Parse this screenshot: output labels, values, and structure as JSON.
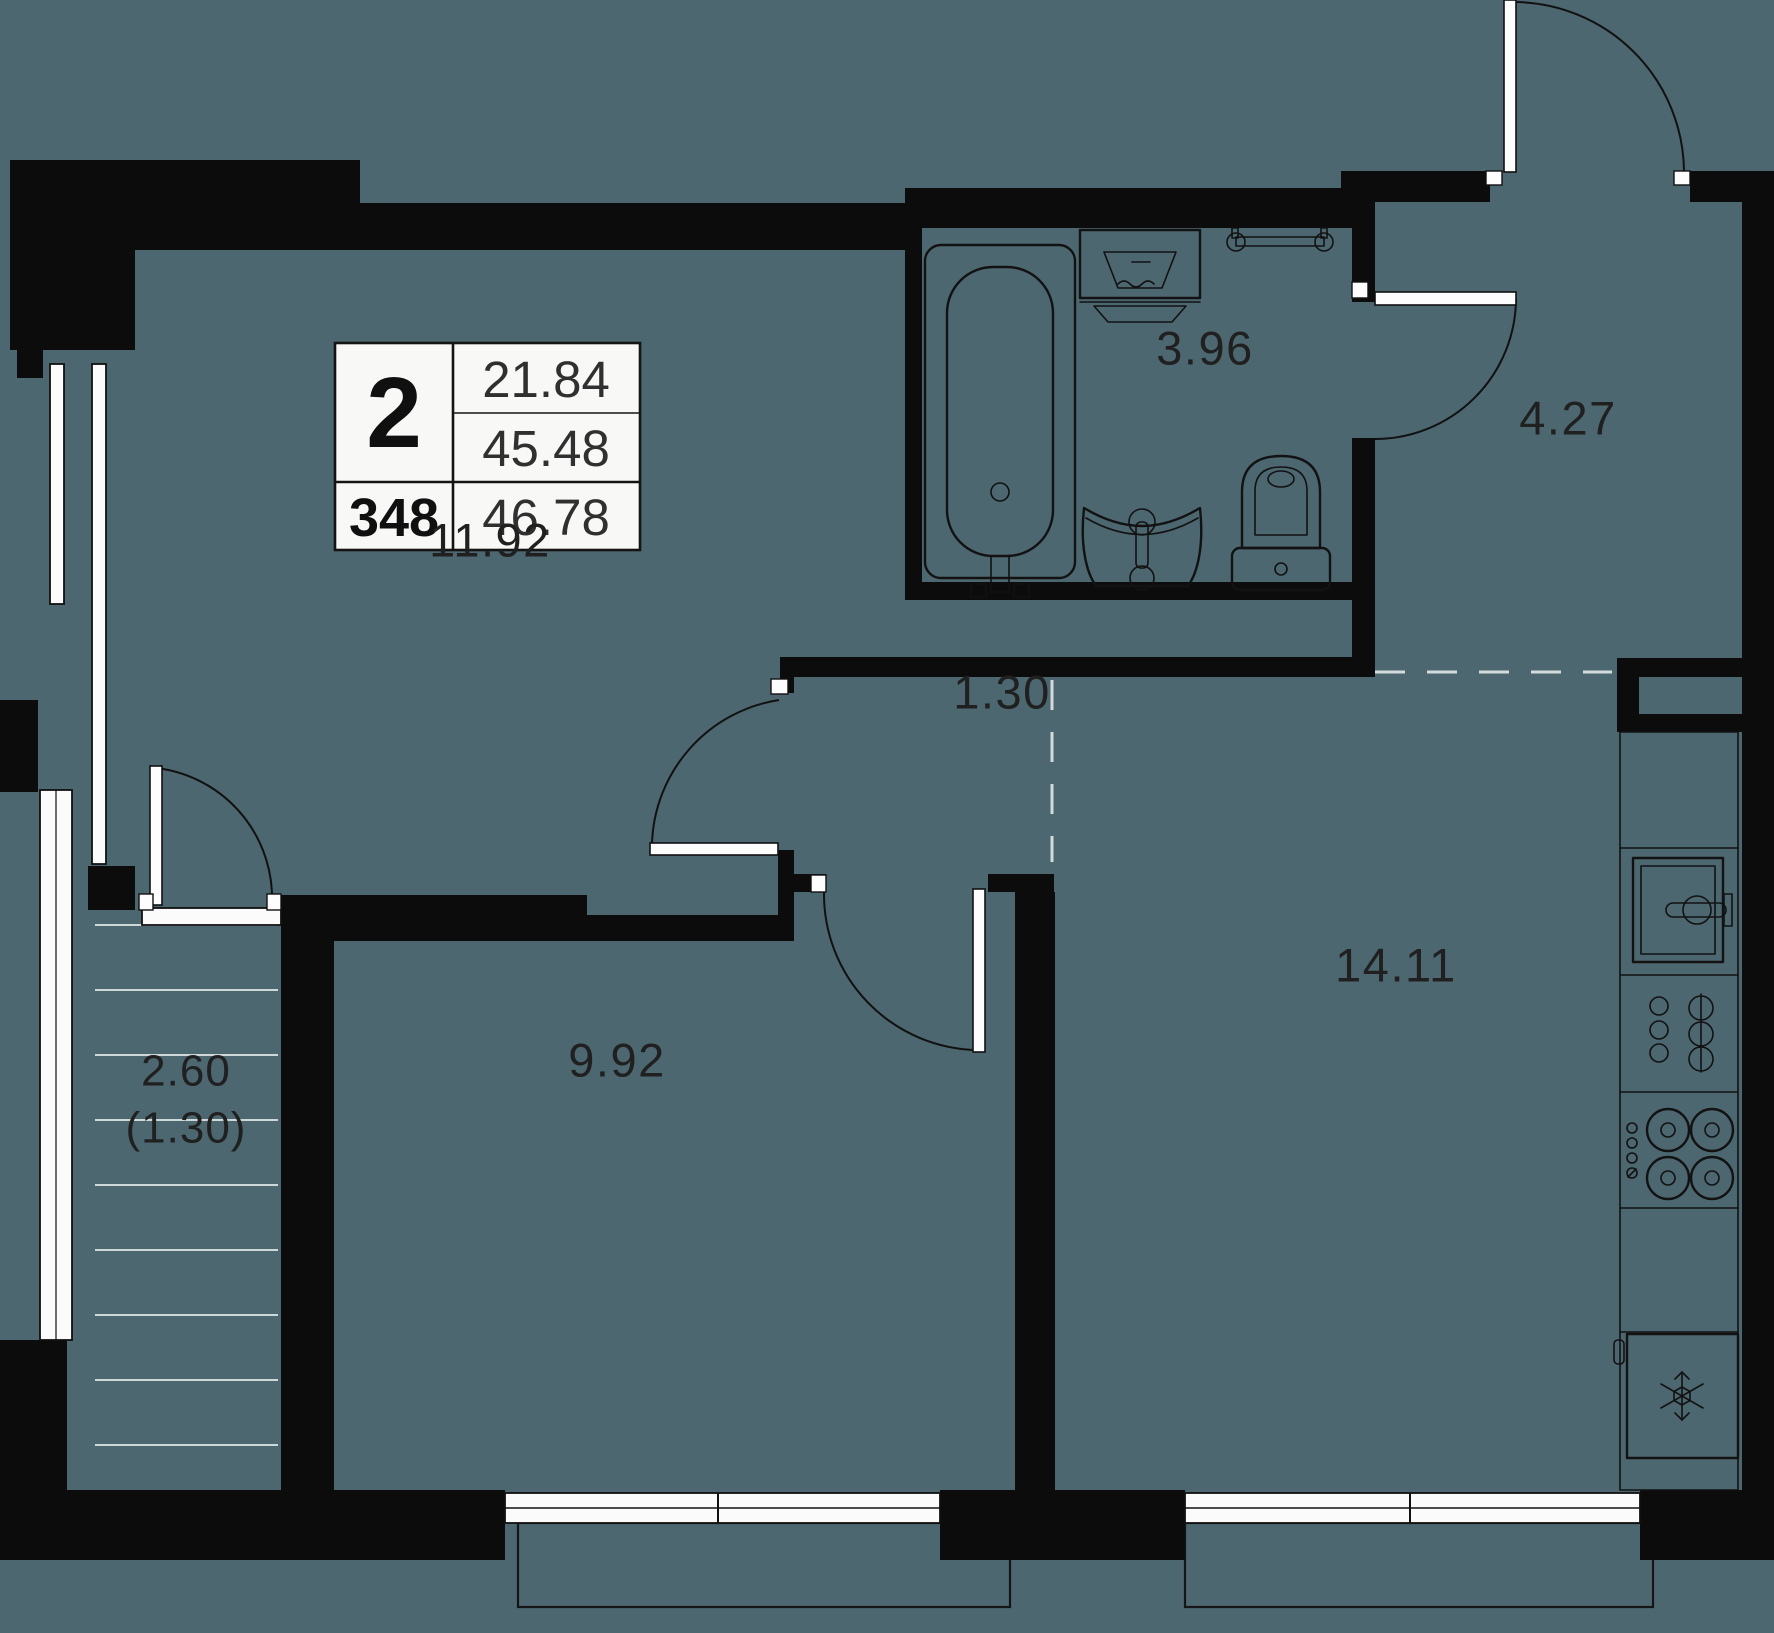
{
  "plan": {
    "colors": {
      "background": "#4C6770",
      "wall": "#0C0C0C",
      "fixture_line": "#121212",
      "window_fill": "#FBFBFB",
      "text": "#202020"
    },
    "legend": {
      "rooms_count": "2",
      "unit_number": "348",
      "living_area": "21.84",
      "apartment_area": "45.48",
      "total_area": "46.78"
    },
    "rooms": {
      "living_room": {
        "area": "11.92"
      },
      "bathroom": {
        "area": "3.96"
      },
      "hallway": {
        "area": "4.27"
      },
      "corridor": {
        "area": "1.30"
      },
      "bedroom": {
        "area": "9.92"
      },
      "kitchen": {
        "area": "14.11"
      },
      "balcony": {
        "area": "2.60",
        "counted_area": "(1.30)"
      }
    }
  }
}
